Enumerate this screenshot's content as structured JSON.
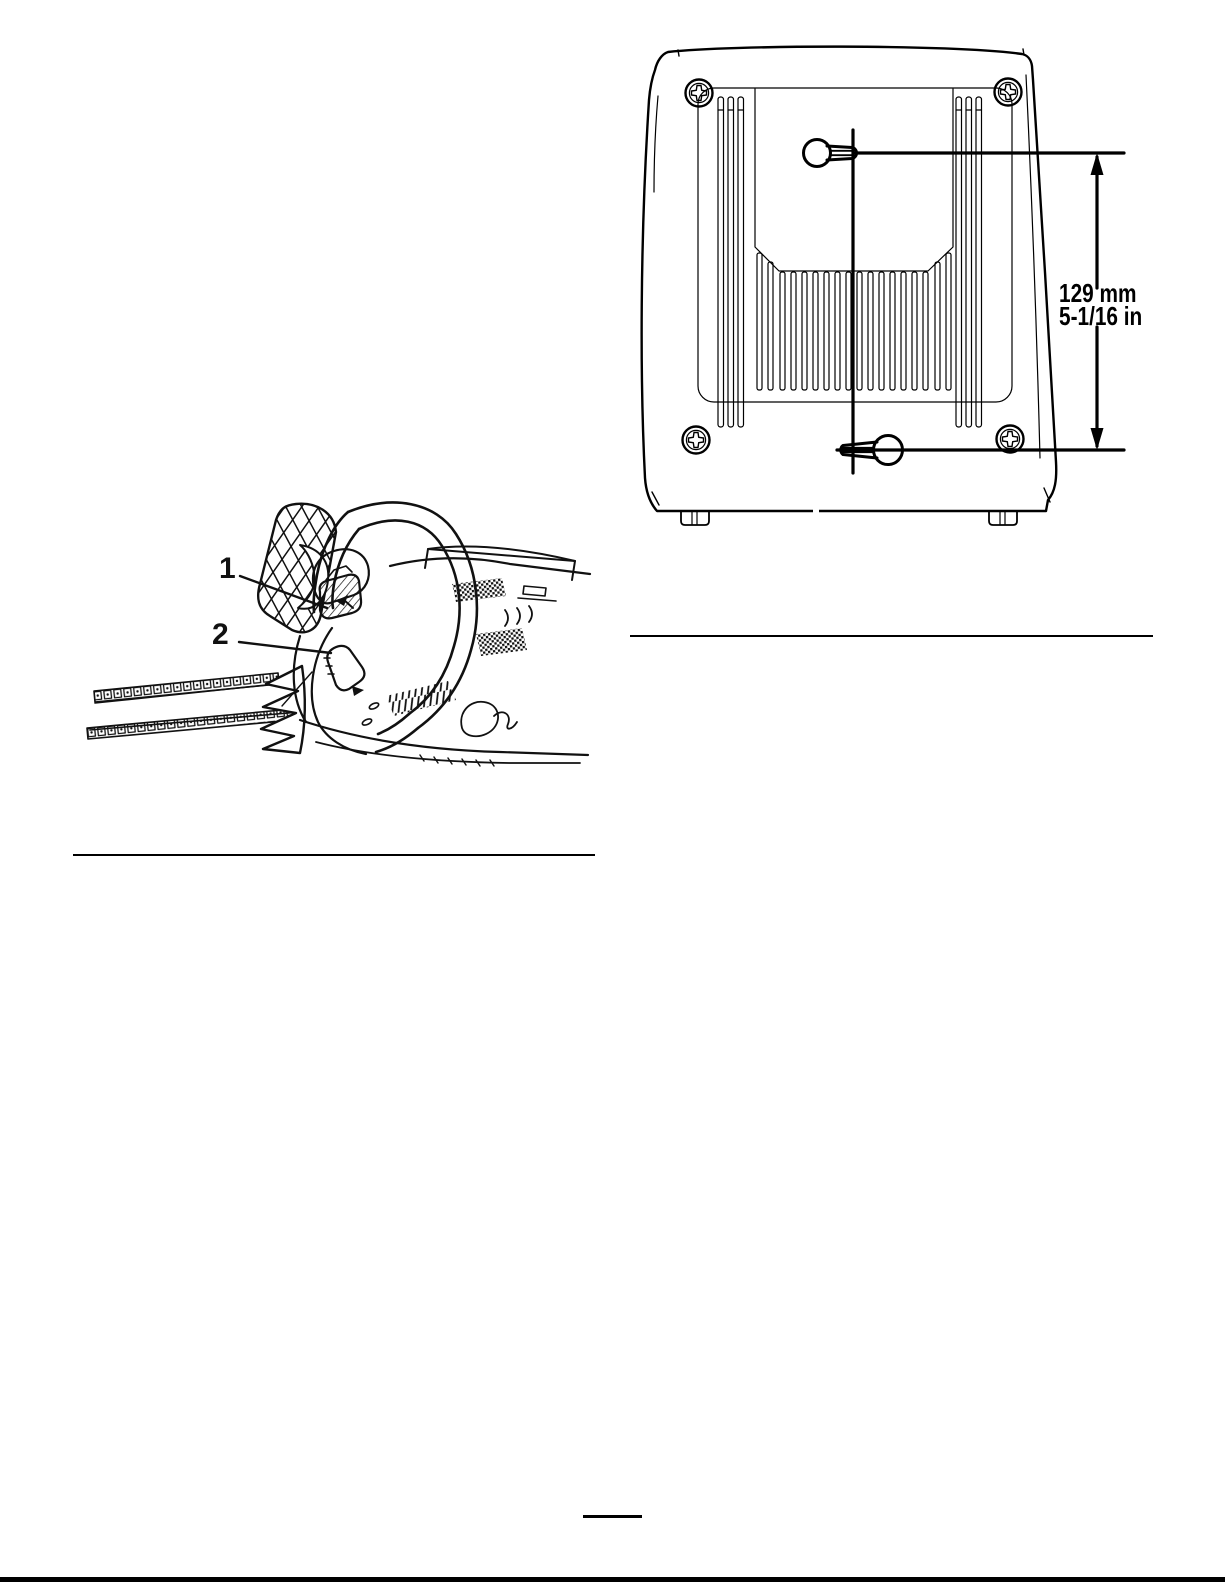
{
  "page": {
    "type": "manual-page-with-figures",
    "colors": {
      "paper": "#ffffff",
      "ink": "#000000"
    }
  },
  "figures": {
    "charger_back": {
      "description": "rear view of battery charger with keyhole mounting slots",
      "dimension": {
        "metric": "129 mm",
        "imperial": "5-1/16 in"
      }
    },
    "chainsaw": {
      "description": "chainsaw front section with oil cap and oil level window",
      "callouts": [
        {
          "number": "1"
        },
        {
          "number": "2"
        }
      ]
    }
  }
}
